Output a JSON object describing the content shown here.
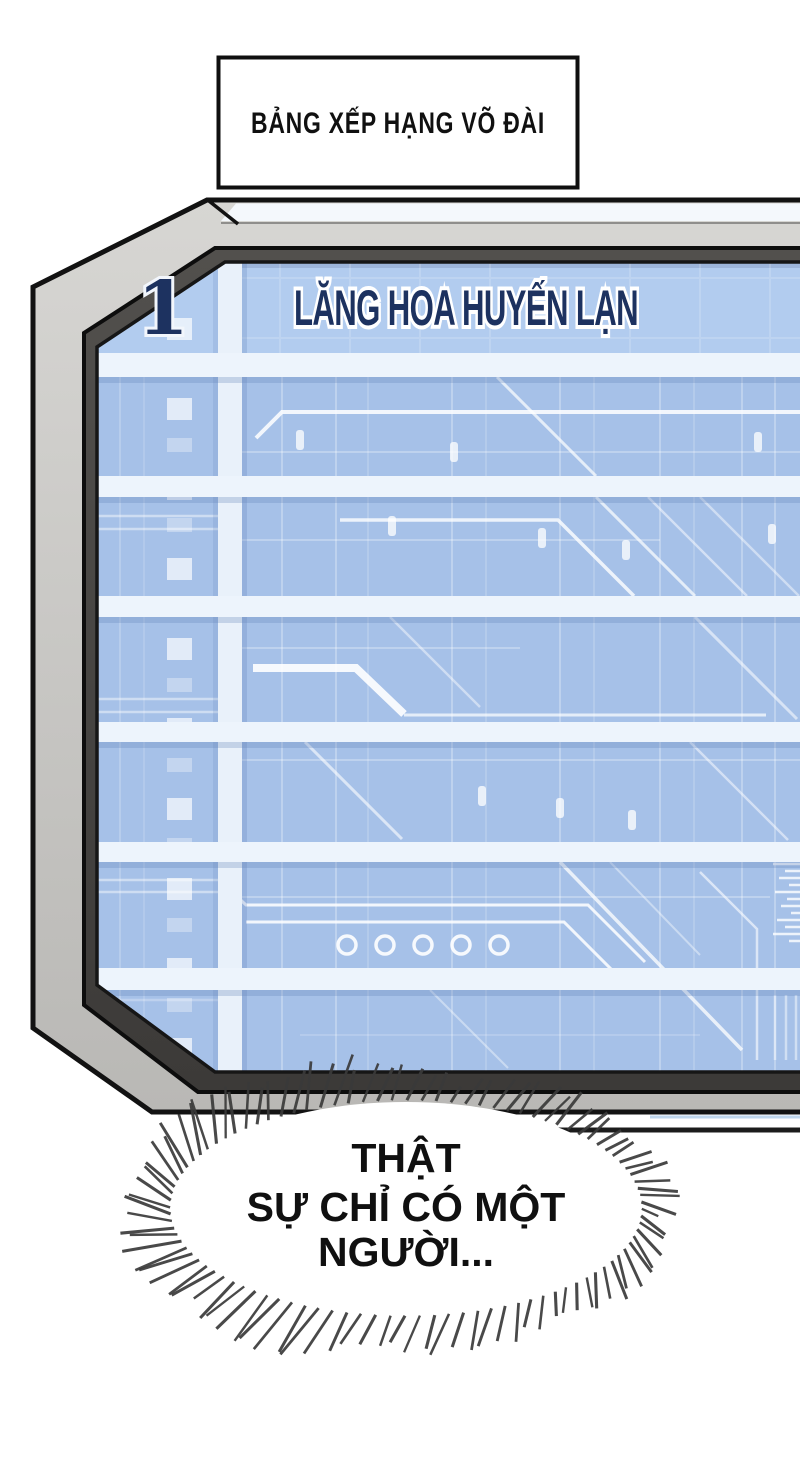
{
  "title_box": {
    "text": "BẢNG XẾP HẠNG VÕ ĐÀI"
  },
  "ranking_board": {
    "rows": [
      {
        "rank": "1",
        "name": "LĂNG HOA HUYẾN LẠN"
      }
    ],
    "empty_row_count": 6
  },
  "speech_bubble": {
    "lines": [
      "THẬT",
      "SỰ CHỈ CÓ MỘT",
      "NGƯỜI..."
    ]
  },
  "colors": {
    "screen_blue": "#a6c1e8",
    "row1_blue": "#b2ccef",
    "band_white": "#edf4fc",
    "bezel_gray": "#c9c8c5",
    "bezel_dark": "#4c4a47",
    "text_navy": "#1d3260",
    "spike_gray": "#3a3a3a"
  }
}
